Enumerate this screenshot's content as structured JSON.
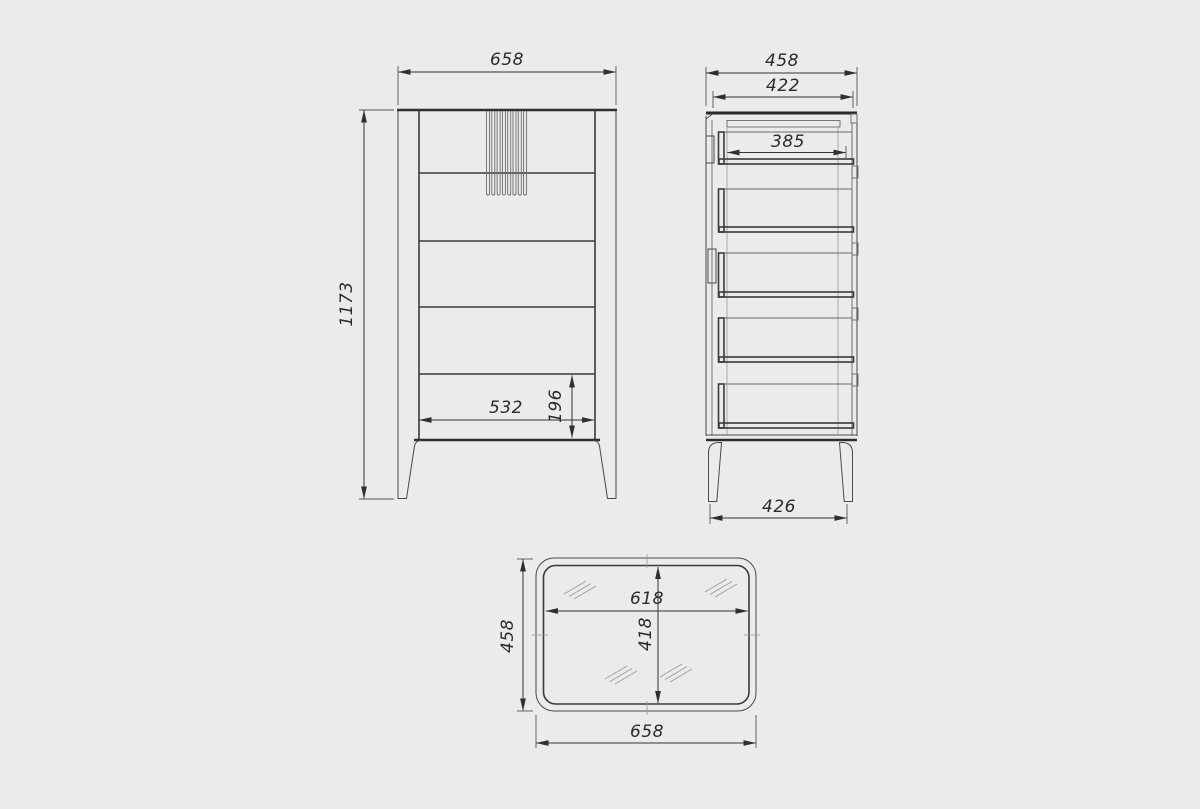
{
  "page": {
    "background_color": "#ebebeb",
    "object_line_color": "#2e2e2e",
    "dimension_line_color": "#333333",
    "drawing_type": "furniture-orthographic-views"
  },
  "dimensions": {
    "front": {
      "width": "658",
      "height": "1173",
      "inner_width": "532",
      "bottom_drawer_height": "196"
    },
    "side": {
      "overall_depth": "458",
      "top_depth": "422",
      "drawer_depth": "385",
      "leg_span": "426"
    },
    "top": {
      "inner_width": "618",
      "inner_depth": "418",
      "overall_depth": "458",
      "overall_width": "658"
    }
  }
}
